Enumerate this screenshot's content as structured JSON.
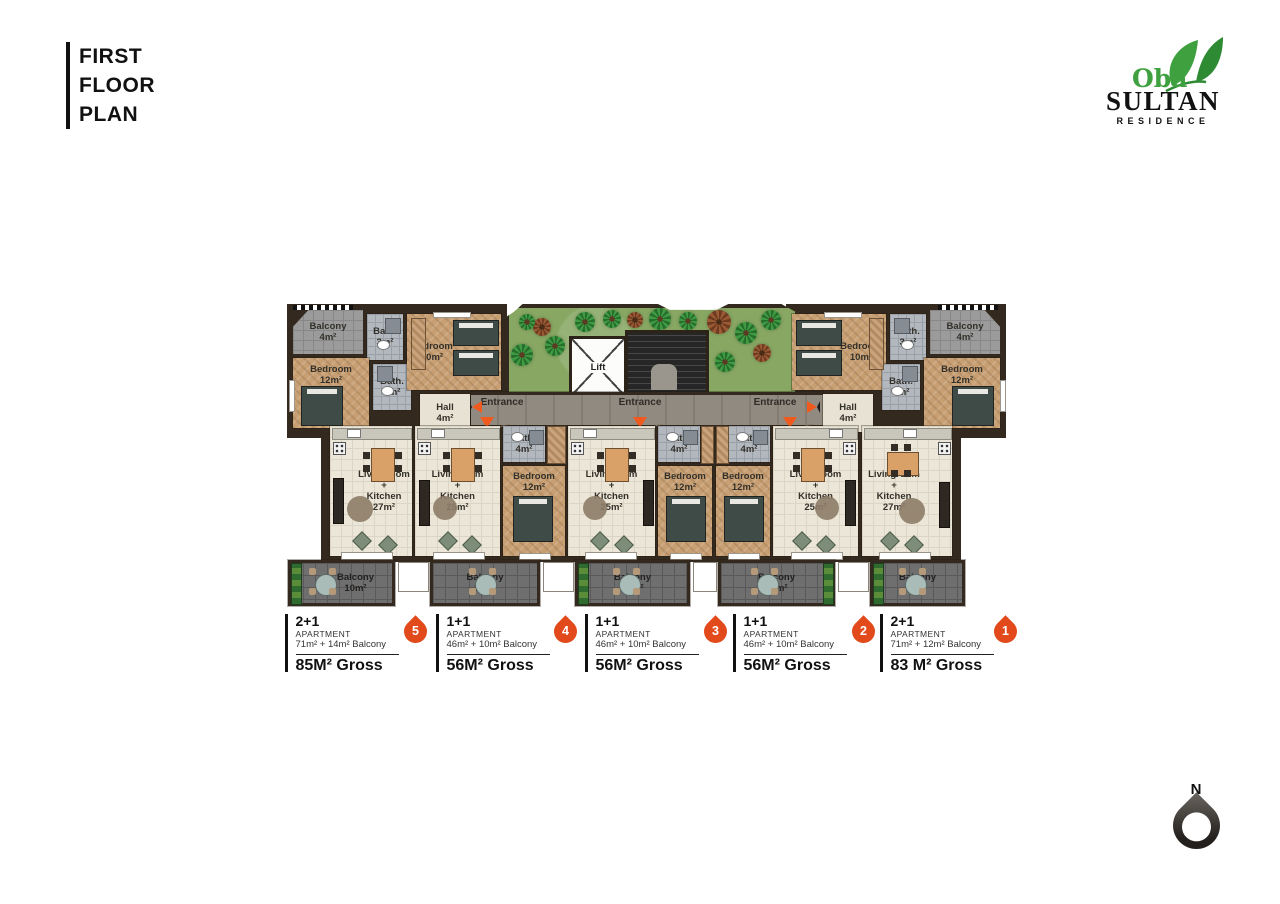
{
  "header": {
    "lines": [
      "FIRST",
      "FLOOR",
      "PLAN"
    ]
  },
  "logo": {
    "oba": "Oba",
    "name": "SULTAN",
    "residence": "RESIDENCE"
  },
  "compass": {
    "north": "N"
  },
  "colors": {
    "accent_orange": "#E2491B",
    "brand_green": "#3FA03F",
    "wall_dark": "#33291F",
    "grass_green": "#87A763"
  },
  "plan": {
    "labels": {
      "balcony": "Balcony",
      "bath": "Bath.",
      "bedroom": "Bedroom",
      "hall": "Hall",
      "lift": "Lift",
      "entrance": "Entrance",
      "livingroom": "Livingroom",
      "plus": "+",
      "kitchen": "Kitchen"
    },
    "areas": {
      "a3": "3m²",
      "a4": "4m²",
      "a8": "8m²",
      "a10": "10m²",
      "a12": "12m²",
      "a25": "25m²",
      "a27": "27m²"
    }
  },
  "legend": {
    "items": [
      {
        "type": "2+1",
        "subtitle": "APARTMENT",
        "detail": "71m² + 14m² Balcony",
        "gross": "85M² Gross",
        "badge": "5"
      },
      {
        "type": "1+1",
        "subtitle": "APARTMENT",
        "detail": "46m² + 10m² Balcony",
        "gross": "56M² Gross",
        "badge": "4"
      },
      {
        "type": "1+1",
        "subtitle": "APARTMENT",
        "detail": "46m² + 10m² Balcony",
        "gross": "56M² Gross",
        "badge": "3"
      },
      {
        "type": "1+1",
        "subtitle": "APARTMENT",
        "detail": "46m² + 10m² Balcony",
        "gross": "56M² Gross",
        "badge": "2"
      },
      {
        "type": "2+1",
        "subtitle": "APARTMENT",
        "detail": "71m² + 12m² Balcony",
        "gross": "83 M² Gross",
        "badge": "1"
      }
    ]
  }
}
